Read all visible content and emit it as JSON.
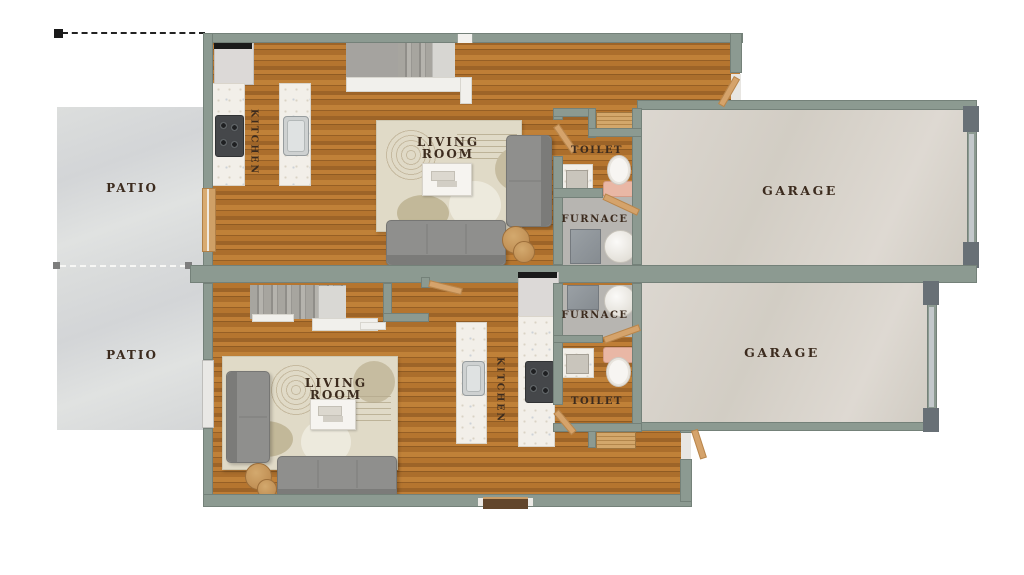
{
  "plan_title": "duplex-floor-plan",
  "labels": {
    "patio": "PATIO",
    "kitchen": "KITCHEN",
    "living_room": "LIVING ROOM",
    "toilet": "TOILET",
    "furnace": "FURNACE",
    "garage": "GARAGE"
  },
  "colors": {
    "wall": "#8c9a91",
    "wall_dark": "#687076",
    "wood_floor": "#b0722e",
    "patio_floor": "#d8dad9",
    "garage_floor": "#d6d1c9",
    "concrete_floor": "#b7b5b1",
    "label": "#3c2b1e",
    "door": "#d5a36b",
    "rug": "#e0dac7",
    "sofa": "#8f8f8d",
    "marble": "#f2efe9",
    "toilet_seat_pink": "#e9b7a5",
    "side_table_wood": "#c79a5f"
  },
  "units": [
    {
      "id": "unit-a",
      "position": "top",
      "rooms": [
        "patio",
        "kitchen",
        "living-room",
        "toilet",
        "furnace",
        "garage"
      ]
    },
    {
      "id": "unit-b",
      "position": "bottom",
      "rooms": [
        "patio",
        "kitchen",
        "living-room",
        "toilet",
        "furnace",
        "garage"
      ]
    }
  ]
}
